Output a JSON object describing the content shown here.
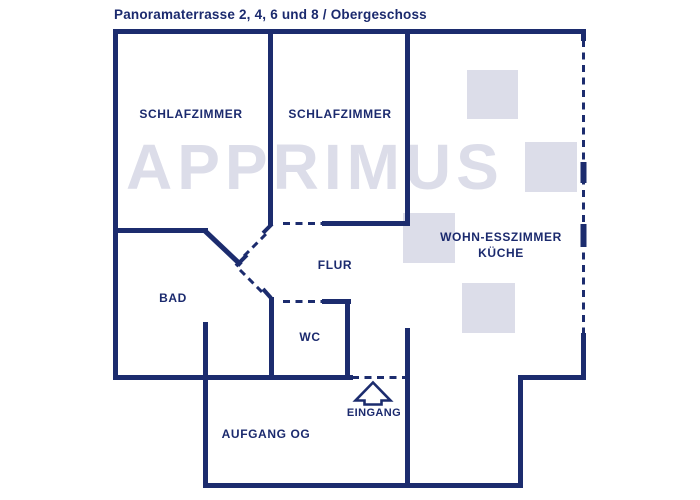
{
  "title": "Panoramaterrasse 2, 4, 6 und 8 / Obergeschoss",
  "watermark": {
    "text": "APPRIMUS"
  },
  "rooms": {
    "schlafzimmer1": "SCHLAFZIMMER",
    "schlafzimmer2": "SCHLAFZIMMER",
    "flur": "FLUR",
    "bad": "BAD",
    "wc": "WC",
    "wohn_esszimmer": "WOHN-ESSZIMMER",
    "kueche": "KÜCHE",
    "eingang": "EINGANG",
    "aufgang": "AUFGANG OG"
  },
  "icons": {
    "entrance_arrow": "up-arrow-outline"
  },
  "colors": {
    "wall": "#1c2c6e",
    "label_text": "#1b2a6e",
    "watermark": "#dcdde9",
    "background": "#ffffff"
  }
}
